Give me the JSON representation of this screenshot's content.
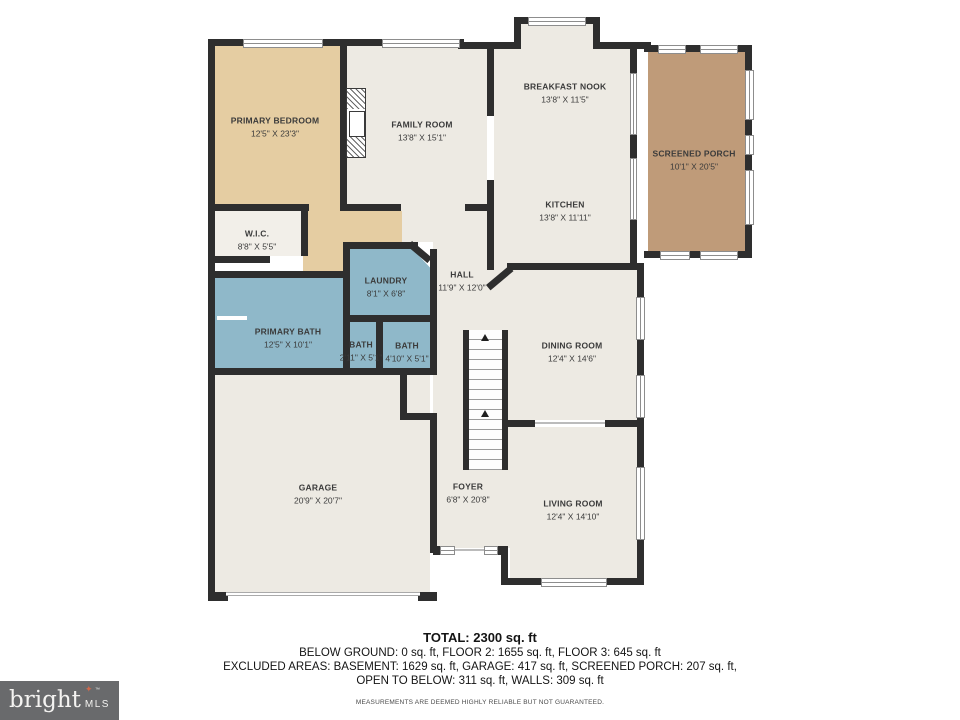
{
  "rooms": [
    {
      "name": "PRIMARY BEDROOM",
      "dims": "12'5\" X 23'3\""
    },
    {
      "name": "W.I.C.",
      "dims": "8'8\" X 5'5\""
    },
    {
      "name": "FAMILY ROOM",
      "dims": "13'8\" X 15'1\""
    },
    {
      "name": "BREAKFAST NOOK",
      "dims": "13'8\" X 11'5\""
    },
    {
      "name": "KITCHEN",
      "dims": "13'8\" X 11'11\""
    },
    {
      "name": "SCREENED PORCH",
      "dims": "10'1\" X 20'5\""
    },
    {
      "name": "LAUNDRY",
      "dims": "8'1\" X 6'8\""
    },
    {
      "name": "HALL",
      "dims": "11'9\" X 12'0\""
    },
    {
      "name": "PRIMARY BATH",
      "dims": "12'5\" X 10'1\""
    },
    {
      "name": "BATH",
      "dims": "2'11\" X 5'1\""
    },
    {
      "name": "BATH",
      "dims": "4'10\" X 5'1\""
    },
    {
      "name": "DINING ROOM",
      "dims": "12'4\" X 14'6\""
    },
    {
      "name": "GARAGE",
      "dims": "20'9\" X 20'7\""
    },
    {
      "name": "FOYER",
      "dims": "6'8\" X 20'8\""
    },
    {
      "name": "LIVING ROOM",
      "dims": "12'4\" X 14'10\""
    }
  ],
  "summary": {
    "total": "TOTAL: 2300 sq. ft",
    "line2": "BELOW GROUND: 0 sq. ft, FLOOR 2: 1655 sq. ft, FLOOR 3: 645 sq. ft",
    "line3": "EXCLUDED AREAS: BASEMENT: 1629 sq. ft, GARAGE: 417 sq. ft, SCREENED PORCH: 207 sq. ft,",
    "line4": "OPEN TO BELOW: 311 sq. ft, WALLS: 309 sq. ft"
  },
  "footer": {
    "brand": "bright",
    "brand_tm": "™",
    "brand_suffix": "MLS",
    "star_icon": "✦",
    "disclaimer": "MEASUREMENTS ARE DEEMED HIGHLY RELIABLE BUT NOT GUARANTEED."
  },
  "colors": {
    "wall": "#2e2e2e",
    "bedroom_tan": "#e5cda2",
    "bath_blue": "#8fb8c9",
    "porch_brown": "#bf9b79",
    "room_cream": "#edeae3",
    "logo_bg": "#696a6c",
    "logo_star": "#d2684b"
  }
}
